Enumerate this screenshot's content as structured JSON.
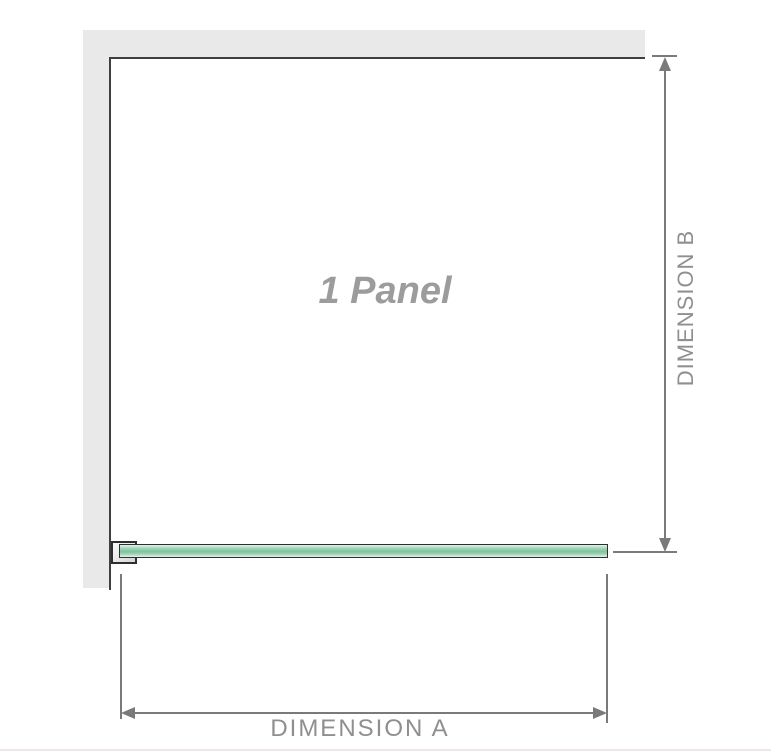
{
  "diagram": {
    "title": "1 Panel shower screen dimension diagram",
    "panel_label": "1 Panel",
    "dimension_a": {
      "label": "DIMENSION A",
      "orientation": "horizontal",
      "measures": "panel width"
    },
    "dimension_b": {
      "label": "DIMENSION B",
      "orientation": "vertical",
      "measures": "panel height"
    }
  },
  "colors": {
    "background": "#ffffff",
    "wall-fill": "#e9e9e9",
    "wall-edge": "#3f3f3f",
    "dim-line": "#7a7a7a",
    "dim-text": "#8f8f8f",
    "panel-text": "#9c9c9c",
    "glass-border": "#2f2f2f",
    "glass-light": "#e4f3ea",
    "glass-mid": "#9ed3b5",
    "glass-dark": "#7fc29d",
    "bracket-light": "#fafafa",
    "bracket-dark": "#d6d6d6",
    "baseline": "#ede7e7"
  }
}
